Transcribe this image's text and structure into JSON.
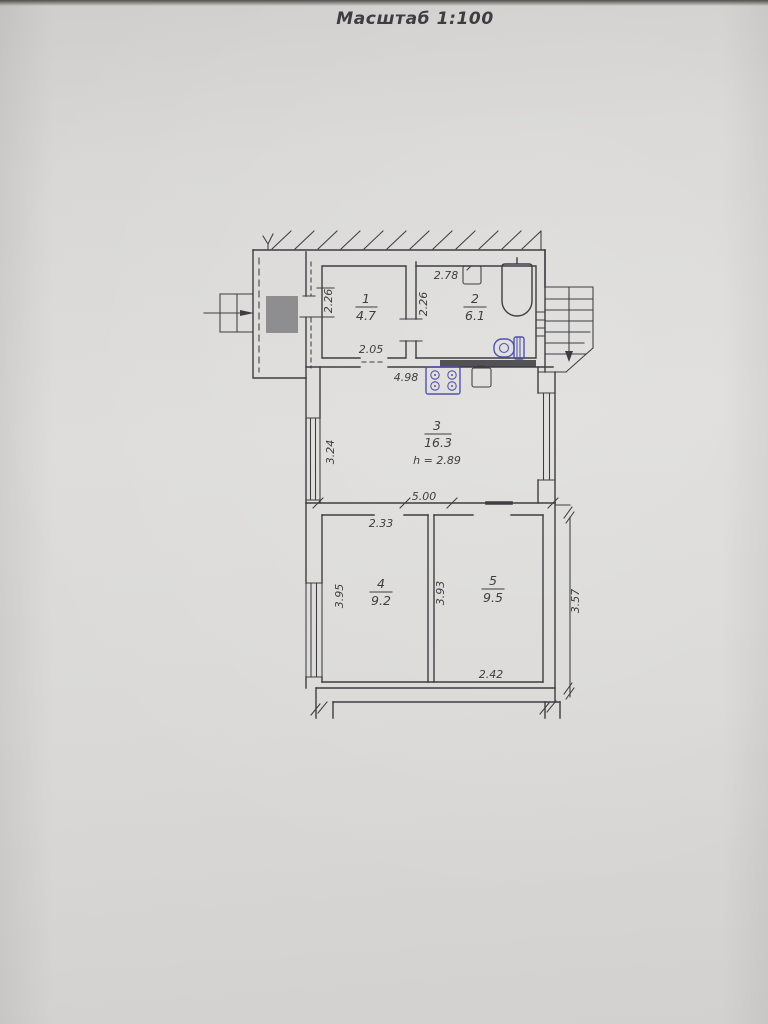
{
  "title": "Масштаб 1:100",
  "colors": {
    "paper": "#d9d8d6",
    "ink": "#3e3d42",
    "fixture": "#5052aa",
    "shaft": "#8e8e90",
    "paper_edge": "#504e4a"
  },
  "rooms": [
    {
      "number": "1",
      "area": "4.7"
    },
    {
      "number": "2",
      "area": "6.1"
    },
    {
      "number": "3",
      "area": "16.3",
      "ceiling_height": "h = 2.89"
    },
    {
      "number": "4",
      "area": "9.2"
    },
    {
      "number": "5",
      "area": "9.5"
    }
  ],
  "dimensions": {
    "room1_depth": "2.26",
    "room1_width": "2.05",
    "room2_width": "2.78",
    "room2_depth": "2.26",
    "room3_width": "4.98",
    "room3_depth": "3.24",
    "rooms45_total_width": "5.00",
    "room4_width": "2.33",
    "room4_depth": "3.95",
    "room5_depth": "3.93",
    "room5_width": "2.42",
    "side_extension": "3.57"
  }
}
